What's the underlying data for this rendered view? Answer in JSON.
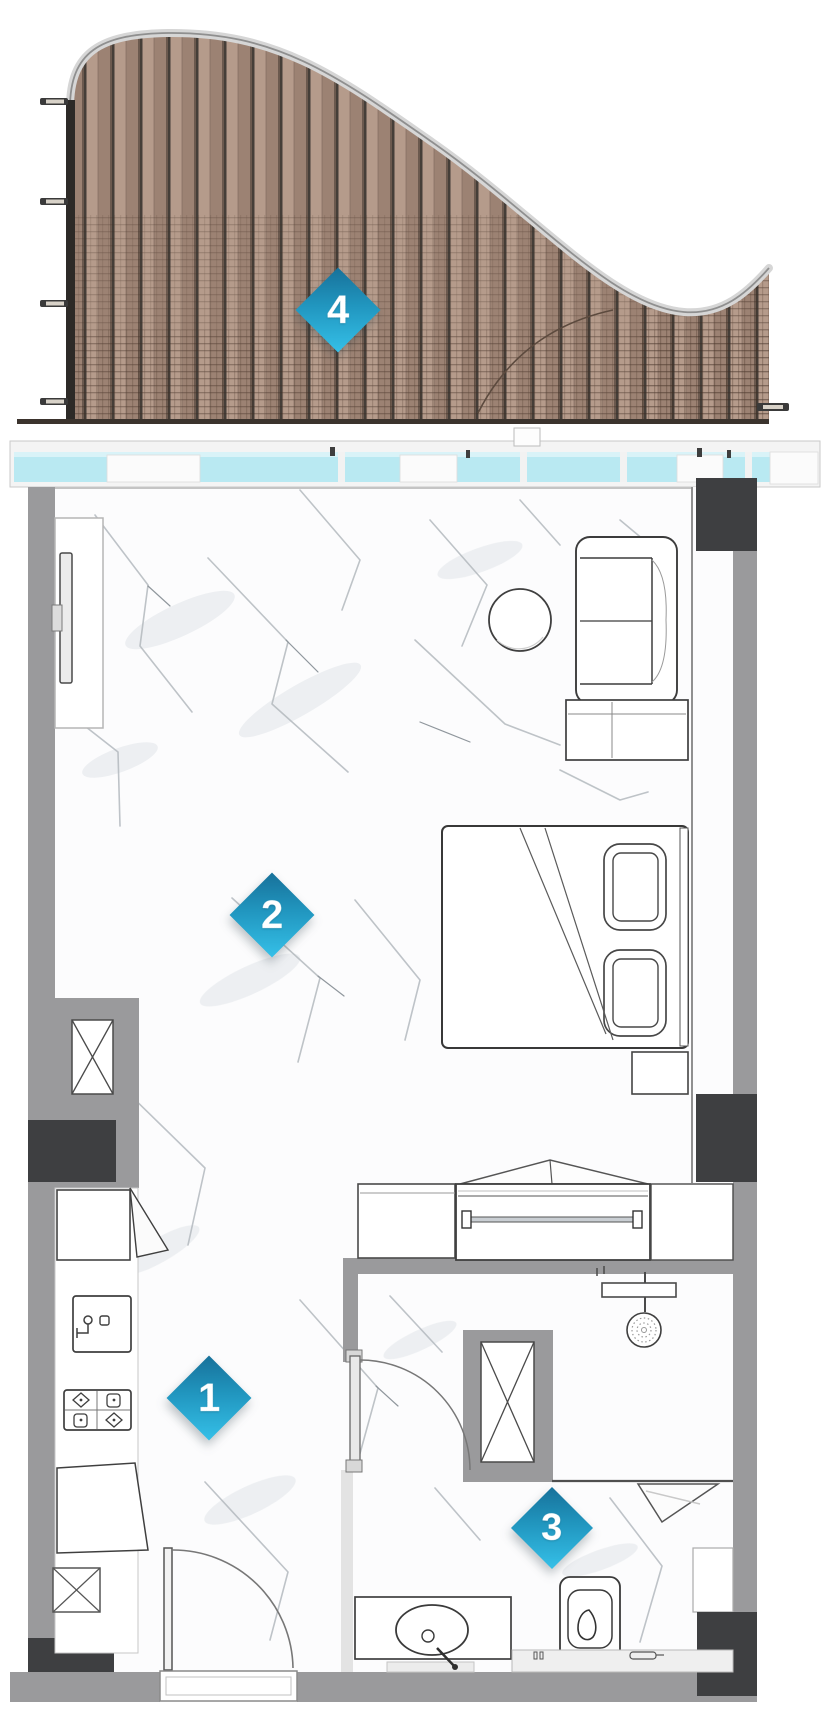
{
  "markers": [
    {
      "label": "1"
    },
    {
      "label": "2"
    },
    {
      "label": "3"
    },
    {
      "label": "4"
    }
  ],
  "palette": {
    "marker_gradient_start": "#17719a",
    "marker_gradient_end": "#35c0e8",
    "wall_gray": "#9a9a9c",
    "wall_dark_charcoal": "#3e3f41",
    "glass_blue": "#b9e9f2",
    "wood_light": "#b59b8b",
    "wood_dark": "#9c8273",
    "plank_gap": "#453e38",
    "rail_silver": "#d6d6d6",
    "outline_dark": "#3a3a3a",
    "floor_white": "#fcfcfd",
    "marble_vein": "#b3b9be"
  }
}
